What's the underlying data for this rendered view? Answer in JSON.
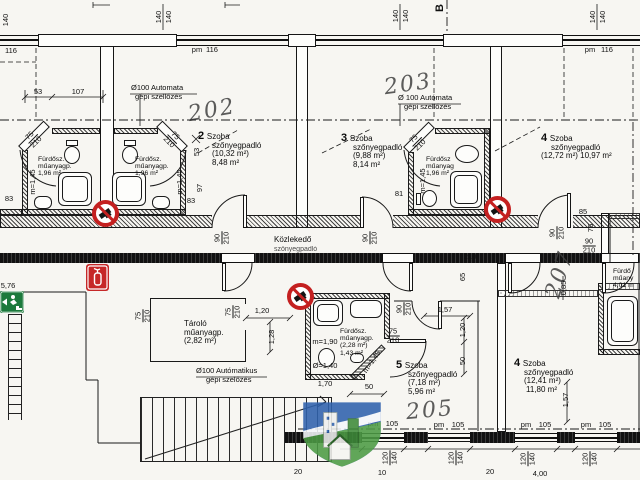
{
  "marker": {
    "section": "B"
  },
  "rooms": {
    "room2": {
      "num": "2",
      "name": "Szoba",
      "floor": "szőnyegpadló",
      "gross": "(10,32 m²)",
      "net": "8,48 m²"
    },
    "room3": {
      "num": "3",
      "name": "Szoba",
      "floor": "szőnyegpadló",
      "gross": "(9,88 m²)",
      "net": "8,14 m²"
    },
    "room4t": {
      "num": "4",
      "name": "Szoba",
      "floor": "szőnyegpadló",
      "area": "(12,72 m²) 10,97 m²"
    },
    "room5": {
      "num": "5",
      "name": "Szoba",
      "floor": "szőnyegpadló",
      "gross": "(7,18 m²)",
      "net": "5,96 m²"
    },
    "room4b": {
      "num": "4",
      "name": "Szoba",
      "floor": "szőnyegpadló",
      "gross": "(12,41 m²)",
      "net": "11,80 m²"
    },
    "corridor": {
      "name": "Közlekedő",
      "floor": "szőnyegpadló"
    },
    "storage": {
      "name": "Tároló",
      "floor": "műanyagp.",
      "gross": "(2,82 m²)"
    }
  },
  "baths": {
    "bath1": {
      "name": "Fürdősz.",
      "floor": "műanyagp.",
      "net": "1,96 m²"
    },
    "bath2": {
      "name": "Fürdősz.",
      "floor": "műanyagp.",
      "net": "1,96 m²"
    },
    "bath3": {
      "name": "Fürdősz",
      "floor": "műanyag",
      "net": "1,96 m²"
    },
    "bath5": {
      "name": "Fürdősz.",
      "floor": "műanyagp.",
      "gross": "(2,28 m²)",
      "net": "1,43 m²"
    },
    "bath4r": {
      "name": "Fürdő",
      "floor": "műany",
      "net": "4,01 m"
    }
  },
  "vents": {
    "v1a": "Ø100 Automata",
    "v1b": "gépi szellőzés",
    "v2a": "Ø 100 Autómata",
    "v2b": "gépi szellőzés",
    "v3a": "Ø100 Autómatikus",
    "v3b": "gépi szelőzés"
  },
  "hand": {
    "h202": "202",
    "h203": "203",
    "h205": "205",
    "h207": "207"
  },
  "icons": {
    "prohibition": "no-open-flame-sign",
    "fire": "fire-extinguisher-sign",
    "exit": "emergency-exit-sign",
    "watermark": "realestate-shield-logo"
  },
  "colors": {
    "red": "#c42020",
    "green": "#1c7a3c",
    "logo_blue": "#2f62ad",
    "logo_green": "#4d9b45",
    "ink": "#161616"
  },
  "dims": [
    {
      "t": "140",
      "x": 6,
      "y": 20,
      "r": -90
    },
    {
      "t": "116",
      "x": 11,
      "y": 51
    },
    {
      "t": "140",
      "x": 159,
      "y": 17,
      "r": -90
    },
    {
      "t": "140",
      "x": 169,
      "y": 17,
      "r": -90
    },
    {
      "t": "pm",
      "x": 197,
      "y": 50
    },
    {
      "t": "116",
      "x": 212,
      "y": 50
    },
    {
      "t": "53",
      "x": 38,
      "y": 92
    },
    {
      "t": "107",
      "x": 78,
      "y": 92
    },
    {
      "t": "140",
      "x": 396,
      "y": 16,
      "r": -90
    },
    {
      "t": "140",
      "x": 406,
      "y": 16,
      "r": -90
    },
    {
      "t": "140",
      "x": 593,
      "y": 17,
      "r": -90
    },
    {
      "t": "140",
      "x": 603,
      "y": 17,
      "r": -90
    },
    {
      "t": "pm",
      "x": 590,
      "y": 50
    },
    {
      "t": "116",
      "x": 607,
      "y": 50
    },
    {
      "t": "75|210",
      "x": 33,
      "y": 139,
      "r": -45
    },
    {
      "t": "75|210",
      "x": 172,
      "y": 139,
      "r": 45
    },
    {
      "t": "75|210",
      "x": 417,
      "y": 142,
      "r": -45
    },
    {
      "t": "m=1,45",
      "x": 33,
      "y": 182,
      "r": -90
    },
    {
      "t": "m=1,45",
      "x": 180,
      "y": 182,
      "r": -90
    },
    {
      "t": "m=1,45",
      "x": 423,
      "y": 181,
      "r": -90
    },
    {
      "t": "53",
      "x": 197,
      "y": 152,
      "r": -90
    },
    {
      "t": "83",
      "x": 9,
      "y": 199
    },
    {
      "t": "83",
      "x": 191,
      "y": 201
    },
    {
      "t": "97",
      "x": 200,
      "y": 188,
      "r": -90
    },
    {
      "t": "81",
      "x": 399,
      "y": 194
    },
    {
      "t": "90|210",
      "x": 222,
      "y": 238,
      "r": -90
    },
    {
      "t": "90|210",
      "x": 370,
      "y": 238,
      "r": -90
    },
    {
      "t": "85",
      "x": 583,
      "y": 212
    },
    {
      "t": "75",
      "x": 591,
      "y": 228,
      "r": -90
    },
    {
      "t": "90|210",
      "x": 557,
      "y": 233,
      "r": -90
    },
    {
      "t": "90|210",
      "x": 589,
      "y": 246
    },
    {
      "t": "0,85",
      "x": 564,
      "y": 288,
      "r": -90
    },
    {
      "t": "210",
      "x": 470,
      "y": 257
    },
    {
      "t": "65",
      "x": 463,
      "y": 277,
      "r": -90
    },
    {
      "t": "5,76",
      "x": 8,
      "y": 286
    },
    {
      "t": "75|210",
      "x": 143,
      "y": 316,
      "r": -90
    },
    {
      "t": "75|210",
      "x": 233,
      "y": 312,
      "r": -90
    },
    {
      "t": "1,20",
      "x": 262,
      "y": 311
    },
    {
      "t": "1,28",
      "x": 272,
      "y": 337,
      "r": -90
    },
    {
      "t": "90|210",
      "x": 404,
      "y": 309,
      "r": -90
    },
    {
      "t": "1,57",
      "x": 445,
      "y": 310
    },
    {
      "t": "1,20",
      "x": 463,
      "y": 330,
      "r": -90
    },
    {
      "t": "50",
      "x": 463,
      "y": 361,
      "r": -90
    },
    {
      "t": "75|210",
      "x": 393,
      "y": 336
    },
    {
      "t": "m=1,90",
      "x": 325,
      "y": 342
    },
    {
      "t": "Ø=1,40",
      "x": 325,
      "y": 366
    },
    {
      "t": "m=1,45",
      "x": 372,
      "y": 362,
      "r": -55
    },
    {
      "t": "50",
      "x": 369,
      "y": 387
    },
    {
      "t": "1,70",
      "x": 325,
      "y": 384
    },
    {
      "t": "1,57",
      "x": 566,
      "y": 400,
      "r": -90
    },
    {
      "t": "pm",
      "x": 373,
      "y": 424
    },
    {
      "t": "105",
      "x": 392,
      "y": 424
    },
    {
      "t": "pm",
      "x": 439,
      "y": 425
    },
    {
      "t": "105",
      "x": 458,
      "y": 425
    },
    {
      "t": "pm",
      "x": 526,
      "y": 425
    },
    {
      "t": "105",
      "x": 545,
      "y": 425
    },
    {
      "t": "pm",
      "x": 586,
      "y": 425
    },
    {
      "t": "105",
      "x": 605,
      "y": 425
    },
    {
      "t": "120|140",
      "x": 390,
      "y": 458,
      "r": -90
    },
    {
      "t": "120|140",
      "x": 456,
      "y": 458,
      "r": -90
    },
    {
      "t": "120|140",
      "x": 528,
      "y": 459,
      "r": -90
    },
    {
      "t": "120|140",
      "x": 590,
      "y": 459,
      "r": -90
    },
    {
      "t": "20",
      "x": 298,
      "y": 472
    },
    {
      "t": "10",
      "x": 382,
      "y": 473
    },
    {
      "t": "20",
      "x": 490,
      "y": 472
    },
    {
      "t": "4,00",
      "x": 540,
      "y": 474
    }
  ]
}
